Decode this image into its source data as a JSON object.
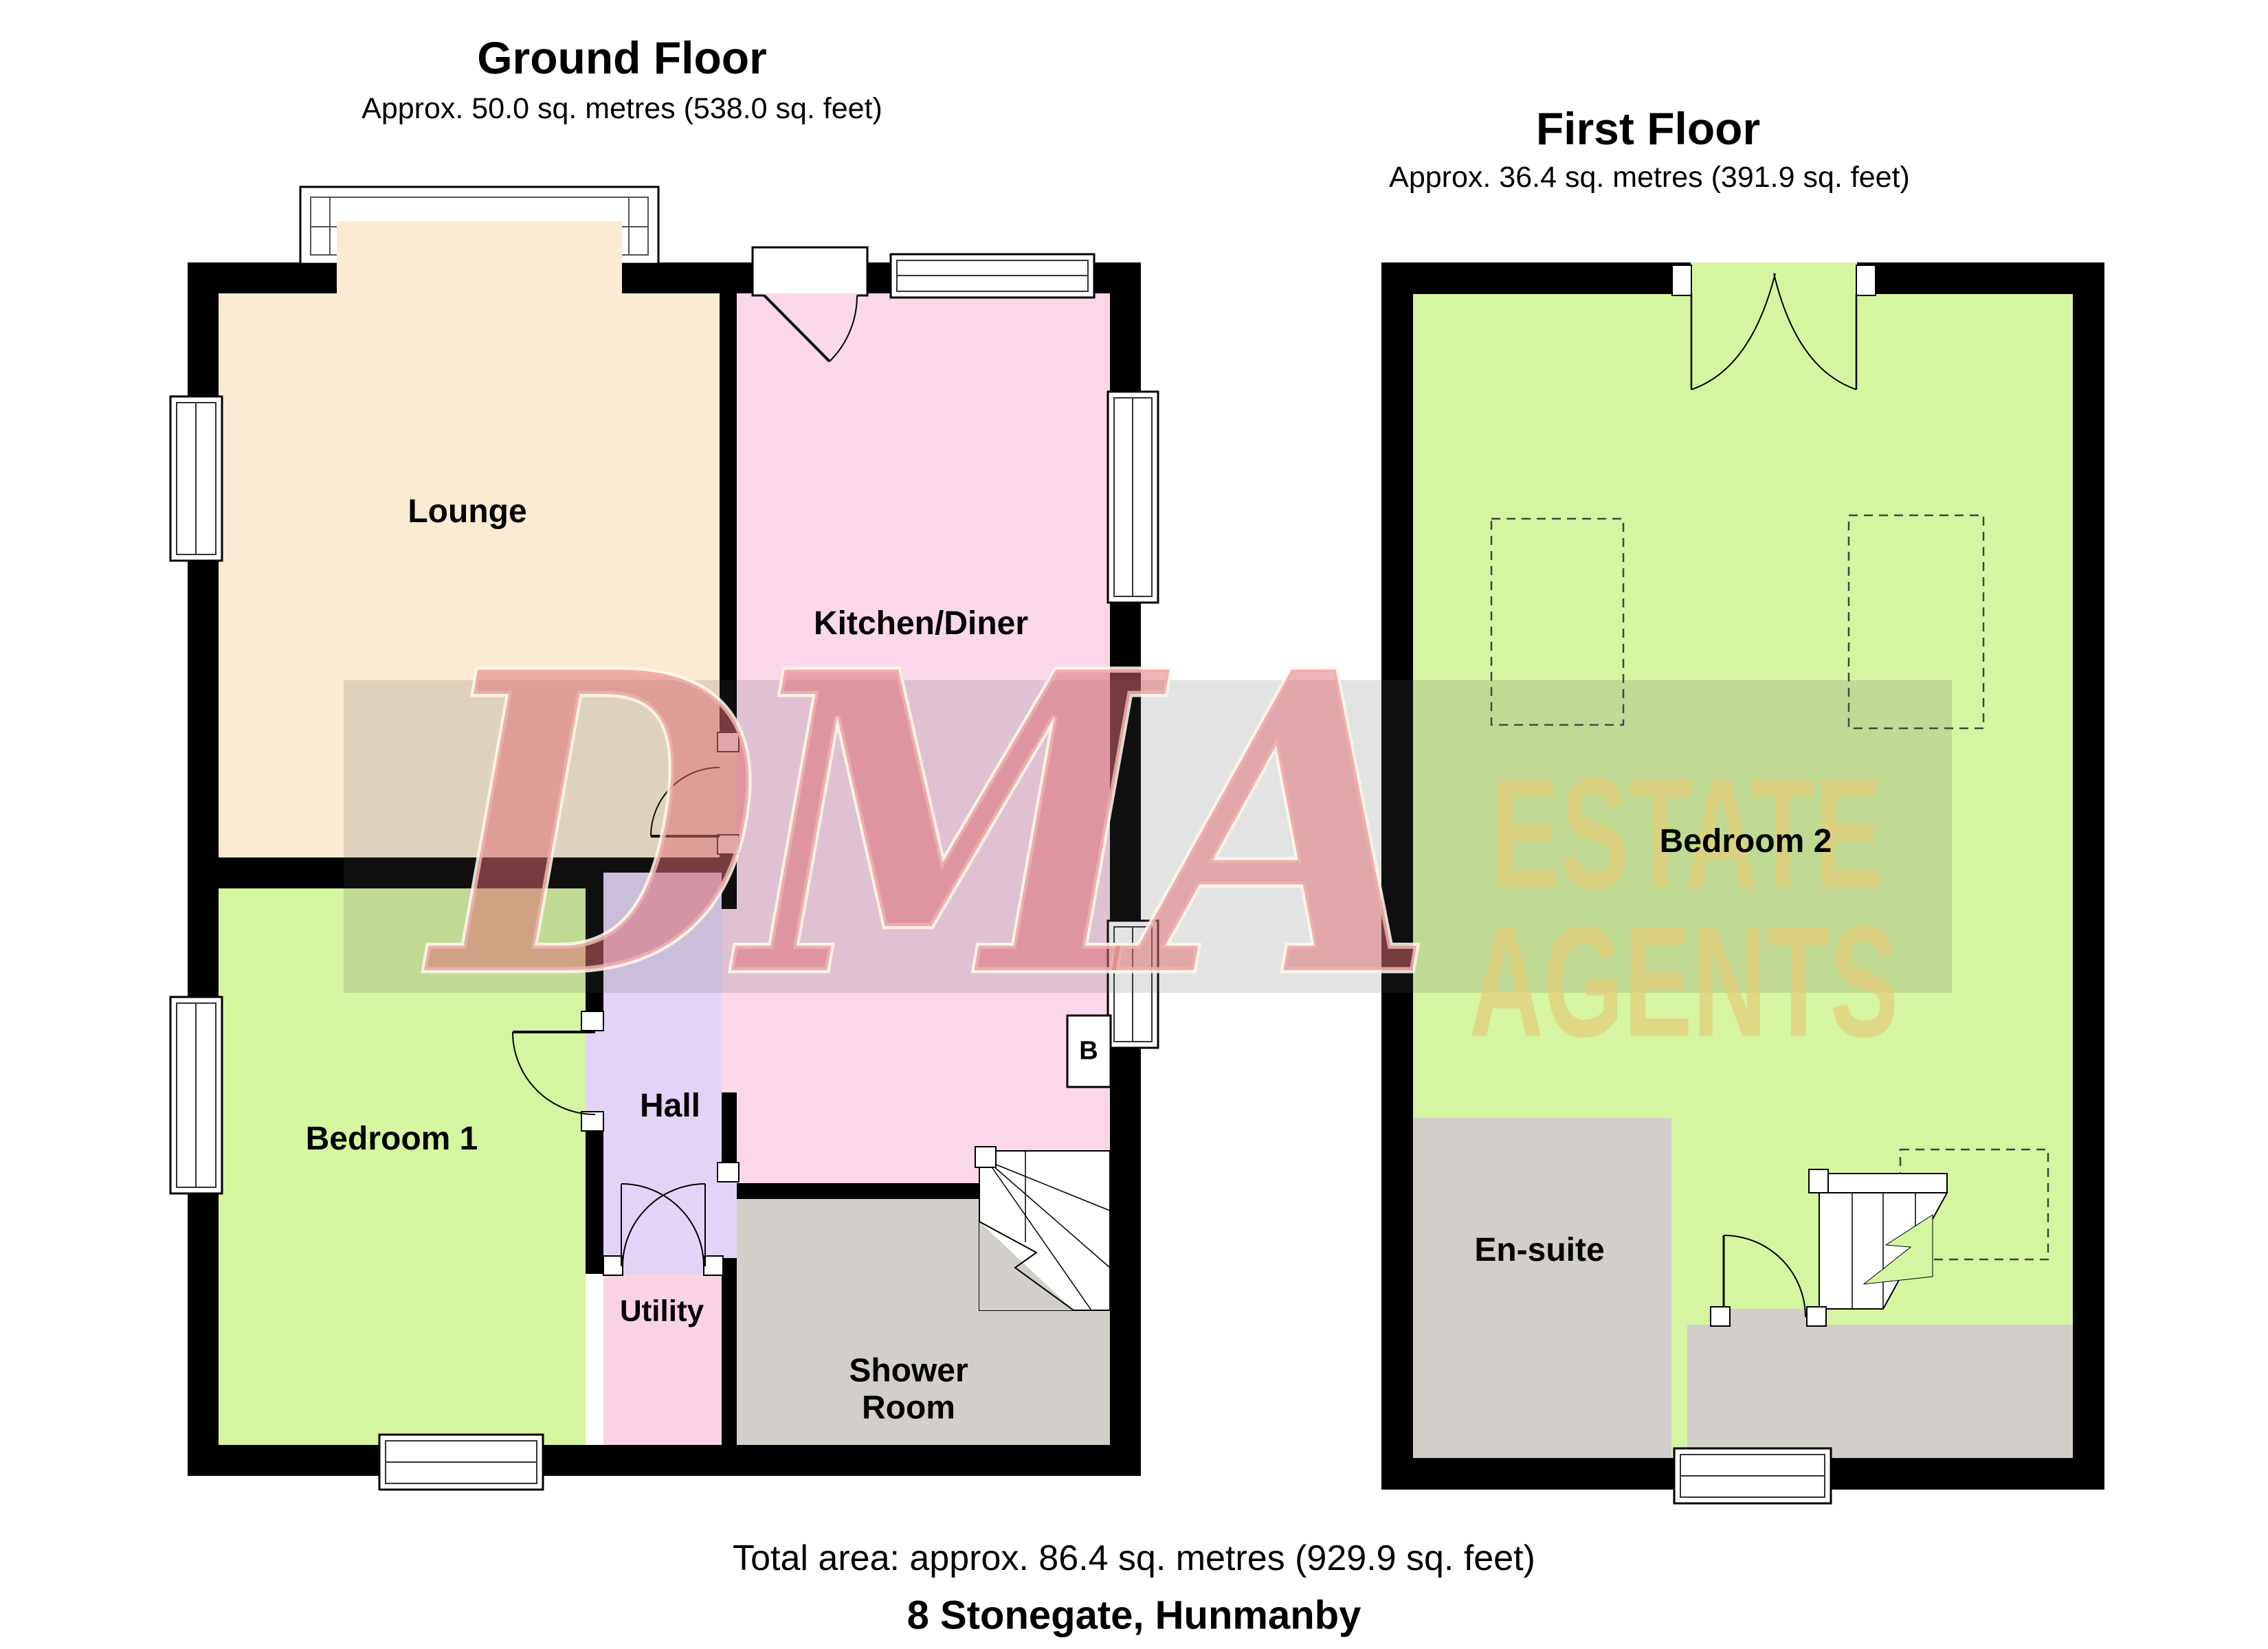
{
  "ground_floor": {
    "title": "Ground Floor",
    "area": "Approx. 50.0 sq. metres (538.0 sq. feet)",
    "rooms": {
      "lounge": "Lounge",
      "kitchen_diner": "Kitchen/Diner",
      "bedroom1": "Bedroom 1",
      "hall": "Hall",
      "utility": "Utility",
      "shower_room_line1": "Shower",
      "shower_room_line2": "Room",
      "boiler": "B"
    }
  },
  "first_floor": {
    "title": "First Floor",
    "area": "Approx. 36.4 sq. metres (391.9 sq. feet)",
    "rooms": {
      "bedroom2": "Bedroom 2",
      "ensuite": "En-suite"
    }
  },
  "footer": {
    "total_area": "Total area: approx. 86.4 sq. metres (929.9 sq. feet)",
    "address": "8 Stonegate, Hunmanby"
  },
  "watermark": {
    "brand": "DMA",
    "word1": "ESTATE",
    "word2": "AGENTS"
  },
  "colors": {
    "wall": "#000000",
    "lounge": "#FAEBD2",
    "kitchen": "#FBD7EA",
    "bedroom": "#D5F5A1",
    "hall": "#E3D3F6",
    "utility": "#FAD2E6",
    "bathroom": "#D2CEC9",
    "window_fill": "#FFFFFF",
    "watermark_red": "#DD6A72",
    "watermark_gold": "#E2D07C"
  }
}
